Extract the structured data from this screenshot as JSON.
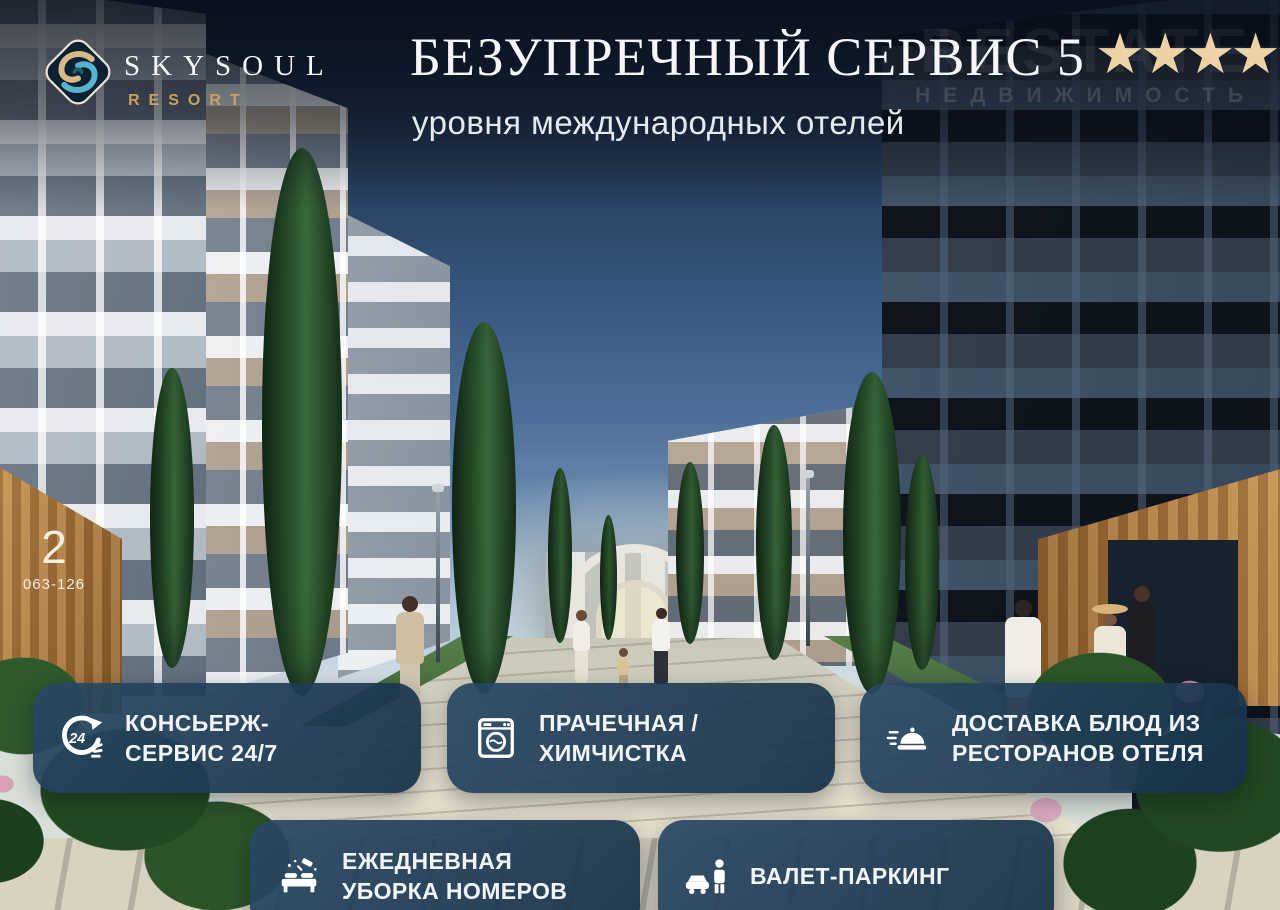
{
  "brand": {
    "name": "SKYSOUL",
    "tagline": "RESORT"
  },
  "hero": {
    "title": "БЕЗУПРЕЧНЫЙ СЕРВИС 5",
    "stars": "★★★★★",
    "subtitle": "уровня международных отелей"
  },
  "watermark": {
    "brand": "RESTATE",
    "caption": "НЕДВИЖИМОСТЬ"
  },
  "building_sign": {
    "number": "2",
    "units": "063-126"
  },
  "features": [
    {
      "icon": "concierge-24-7-icon",
      "line1": "КОНСЬЕРЖ-",
      "line2": "СЕРВИС 24/7"
    },
    {
      "icon": "laundry-icon",
      "line1": "ПРАЧЕЧНАЯ /",
      "line2": "ХИМЧИСТКА"
    },
    {
      "icon": "food-delivery-icon",
      "line1": "ДОСТАВКА БЛЮД ИЗ",
      "line2": "РЕСТОРАНОВ ОТЕЛЯ"
    },
    {
      "icon": "housekeeping-icon",
      "line1": "ЕЖЕДНЕВНАЯ",
      "line2": "УБОРКА НОМЕРОВ"
    },
    {
      "icon": "valet-parking-icon",
      "line1": "ВАЛЕТ-ПАРКИНГ",
      "line2": ""
    }
  ],
  "colors": {
    "star_gold": "#ecd2a4",
    "resort_gold": "#c9a25c",
    "card_bg": "rgba(31,60,86,0.93)",
    "sky_top": "#131e31",
    "title_white": "#f4f6f8"
  }
}
